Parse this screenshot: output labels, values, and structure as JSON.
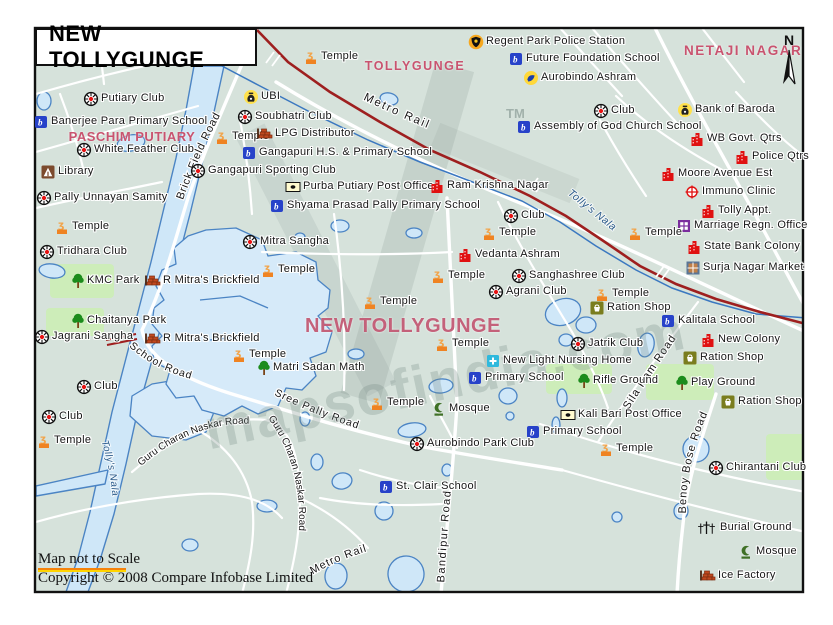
{
  "title": "NEW TOLLYGUNGE",
  "compass": {
    "north": "N"
  },
  "watermark": {
    "text": "mapsofindia.com",
    "tm": "TM"
  },
  "footer": {
    "scale_note": "Map not to Scale",
    "copyright": "Copyright © 2008 Compare Infobase Limited"
  },
  "palette": {
    "background": "#d6e2db",
    "water_fill": "#cfe7f8",
    "water_stroke": "#4b84c4",
    "road": "#ffffff",
    "railway": "#9e1f1f",
    "area_label_pink": "#c9536f",
    "green_patch": "#cdedb9"
  },
  "area_labels": [
    {
      "id": "paschim-putiary",
      "text": "PASCHIM PUTIARY",
      "x": 132,
      "y": 129,
      "size": 13,
      "spacing": 0.5
    },
    {
      "id": "tollygunge",
      "text": "TOLLYGUNGE",
      "x": 415,
      "y": 59,
      "size": 12.5,
      "spacing": 1.5
    },
    {
      "id": "netaji-nagar",
      "text": "NETAJI NAGAR",
      "x": 729,
      "y": 43,
      "size": 13.5,
      "spacing": 1.5,
      "two_line": true
    },
    {
      "id": "new-tollygunge-center",
      "text": "NEW TOLLYGUNGE",
      "x": 403,
      "y": 315,
      "size": 20,
      "spacing": 0.5
    }
  ],
  "road_labels": [
    {
      "id": "brickfield",
      "text": "Brick Field Road",
      "path": "p-brickfield",
      "size": 11,
      "spacing": 0.8,
      "offset": "22%"
    },
    {
      "id": "school-road",
      "text": "School Road",
      "path": "p-school",
      "size": 10.5,
      "spacing": 1,
      "offset": "4%"
    },
    {
      "id": "sree-pally",
      "text": "Sree Pally Road",
      "path": "p-sreepally",
      "size": 10.5,
      "spacing": 1,
      "offset": "2%"
    },
    {
      "id": "guru-1",
      "text": "Guru Charan Naskar Road",
      "path": "p-guru1",
      "size": 10,
      "spacing": 0,
      "offset": "1%"
    },
    {
      "id": "guru-2",
      "text": "Guru Charan Naskar Road",
      "path": "p-guru2",
      "size": 10,
      "spacing": 0,
      "offset": "1%"
    },
    {
      "id": "bandipur",
      "text": "Bandipur Road",
      "path": "p-bandipur",
      "size": 11,
      "spacing": 1.5,
      "offset": "3%"
    },
    {
      "id": "benoy-bose",
      "text": "Benoy Bose Road",
      "path": "p-benoy",
      "size": 11,
      "spacing": 1,
      "offset": "2%"
    },
    {
      "id": "sila-ram",
      "text": "Sila Ram Road",
      "path": "p-silaram",
      "size": 11,
      "spacing": 1,
      "offset": "4%"
    },
    {
      "id": "metro-rail-top",
      "text": "Metro Rail",
      "path": "p-metro1",
      "size": 11.5,
      "spacing": 2,
      "offset": "4%"
    },
    {
      "id": "metro-rail-bottom",
      "text": "Metro Rail",
      "path": "p-metro2",
      "size": 11,
      "spacing": 1,
      "offset": "4%"
    },
    {
      "id": "tollys-nala-right",
      "text": "Tolly's Nala",
      "path": "p-nala-r",
      "size": 10.5,
      "spacing": 0.5,
      "offset": "2%",
      "nala": true
    },
    {
      "id": "tollys-nala-left",
      "text": "Tolly's Nala",
      "path": "p-nala-l",
      "size": 10,
      "spacing": 0.5,
      "offset": "2%",
      "nala": true
    }
  ],
  "pois": [
    {
      "type": "club",
      "x": 91,
      "y": 99,
      "label": "Putiary Club"
    },
    {
      "type": "bank",
      "x": 251,
      "y": 97,
      "label": "UBI"
    },
    {
      "type": "temple",
      "x": 311,
      "y": 57,
      "label": "Temple"
    },
    {
      "type": "police",
      "x": 476,
      "y": 42,
      "label": "Regent Park Police Station"
    },
    {
      "type": "school",
      "x": 516,
      "y": 59,
      "label": "Future Foundation School"
    },
    {
      "type": "ashram",
      "x": 531,
      "y": 78,
      "label": "Aurobindo Ashram"
    },
    {
      "type": "school",
      "x": 41,
      "y": 122,
      "label": "Banerjee Para Primary School"
    },
    {
      "type": "club",
      "x": 245,
      "y": 117,
      "label": "Soubhatri Club"
    },
    {
      "type": "club",
      "x": 601,
      "y": 111,
      "label": "Club"
    },
    {
      "type": "bank",
      "x": 685,
      "y": 110,
      "label": "Bank of Baroda"
    },
    {
      "type": "temple",
      "x": 222,
      "y": 137,
      "label": "Temple"
    },
    {
      "type": "brick",
      "x": 264,
      "y": 134,
      "label": "LPG Distributor"
    },
    {
      "type": "school",
      "x": 524,
      "y": 127,
      "label": "Assembly of God Church School"
    },
    {
      "type": "club",
      "x": 84,
      "y": 150,
      "label": "White Feather Club"
    },
    {
      "type": "school",
      "x": 249,
      "y": 153,
      "label": "Gangapuri H.S. & Primary School"
    },
    {
      "type": "building",
      "x": 697,
      "y": 139,
      "label": "WB Govt. Qtrs"
    },
    {
      "type": "library",
      "x": 48,
      "y": 172,
      "label": "Library"
    },
    {
      "type": "club",
      "x": 198,
      "y": 171,
      "label": "Gangapuri Sporting Club"
    },
    {
      "type": "building",
      "x": 742,
      "y": 157,
      "label": "Police Qtrs"
    },
    {
      "type": "postoffice",
      "x": 293,
      "y": 187,
      "label": "Purba Putiary Post Office"
    },
    {
      "type": "building",
      "x": 437,
      "y": 186,
      "label": "Ram Krishna Nagar"
    },
    {
      "type": "building",
      "x": 668,
      "y": 174,
      "label": "Moore Avenue Est"
    },
    {
      "type": "club",
      "x": 44,
      "y": 198,
      "label": "Pally Unnayan Samity"
    },
    {
      "type": "school",
      "x": 277,
      "y": 206,
      "label": "Shyama Prasad Pally Primary School"
    },
    {
      "type": "clinic",
      "x": 692,
      "y": 192,
      "label": "Immuno Clinic"
    },
    {
      "type": "club",
      "x": 511,
      "y": 216,
      "label": "Club"
    },
    {
      "type": "building",
      "x": 708,
      "y": 211,
      "label": "Tolly Appt."
    },
    {
      "type": "temple",
      "x": 62,
      "y": 227,
      "label": "Temple"
    },
    {
      "type": "marriage",
      "x": 684,
      "y": 226,
      "label": "Marriage Regn. Office"
    },
    {
      "type": "club",
      "x": 250,
      "y": 242,
      "label": "Mitra Sangha"
    },
    {
      "type": "temple",
      "x": 635,
      "y": 233,
      "label": "Temple"
    },
    {
      "type": "temple",
      "x": 489,
      "y": 233,
      "label": "Temple"
    },
    {
      "type": "building",
      "x": 694,
      "y": 247,
      "label": "State Bank Colony"
    },
    {
      "type": "club",
      "x": 47,
      "y": 252,
      "label": "Tridhara Club"
    },
    {
      "type": "building",
      "x": 465,
      "y": 255,
      "label": "Vedanta Ashram"
    },
    {
      "type": "market",
      "x": 693,
      "y": 268,
      "label": "Surja Nagar Market"
    },
    {
      "type": "temple",
      "x": 268,
      "y": 270,
      "label": "Temple"
    },
    {
      "type": "club",
      "x": 519,
      "y": 276,
      "label": "Sanghashree Club"
    },
    {
      "type": "temple",
      "x": 438,
      "y": 276,
      "label": "Temple"
    },
    {
      "type": "tree",
      "x": 78,
      "y": 281,
      "label": "KMC Park"
    },
    {
      "type": "brick",
      "x": 152,
      "y": 281,
      "label": "R Mitra's Brickfield"
    },
    {
      "type": "club",
      "x": 496,
      "y": 292,
      "label": "Agrani Club"
    },
    {
      "type": "temple",
      "x": 602,
      "y": 294,
      "label": "Temple"
    },
    {
      "type": "ration",
      "x": 597,
      "y": 308,
      "label": "Ration Shop"
    },
    {
      "type": "temple",
      "x": 370,
      "y": 302,
      "label": "Temple"
    },
    {
      "type": "tree",
      "x": 78,
      "y": 321,
      "label": "Chaitanya Park"
    },
    {
      "type": "school",
      "x": 668,
      "y": 321,
      "label": "Kalitala School"
    },
    {
      "type": "club",
      "x": 42,
      "y": 337,
      "label": "Jagrani Sangha"
    },
    {
      "type": "brick",
      "x": 152,
      "y": 339,
      "label": "R Mitra's Brickfield"
    },
    {
      "type": "building",
      "x": 708,
      "y": 340,
      "label": "New Colony"
    },
    {
      "type": "temple",
      "x": 442,
      "y": 344,
      "label": "Temple"
    },
    {
      "type": "club",
      "x": 578,
      "y": 344,
      "label": "Jatrik Club"
    },
    {
      "type": "ration",
      "x": 690,
      "y": 358,
      "label": "Ration Shop"
    },
    {
      "type": "temple",
      "x": 239,
      "y": 355,
      "label": "Temple"
    },
    {
      "type": "tree",
      "x": 264,
      "y": 368,
      "label": "Matri Sadan Math"
    },
    {
      "type": "nursing",
      "x": 493,
      "y": 361,
      "label": "New Light Nursing Home"
    },
    {
      "type": "school",
      "x": 475,
      "y": 378,
      "label": "Primary School"
    },
    {
      "type": "tree",
      "x": 584,
      "y": 381,
      "label": "Rifle Ground"
    },
    {
      "type": "tree",
      "x": 682,
      "y": 383,
      "label": "Play Ground"
    },
    {
      "type": "club",
      "x": 84,
      "y": 387,
      "label": "Club"
    },
    {
      "type": "ration",
      "x": 728,
      "y": 402,
      "label": "Ration Shop"
    },
    {
      "type": "temple",
      "x": 377,
      "y": 403,
      "label": "Temple"
    },
    {
      "type": "mosque",
      "x": 439,
      "y": 409,
      "label": "Mosque"
    },
    {
      "type": "club",
      "x": 49,
      "y": 417,
      "label": "Club"
    },
    {
      "type": "postoffice",
      "x": 568,
      "y": 415,
      "label": "Kali Bari Post Office"
    },
    {
      "type": "school",
      "x": 533,
      "y": 432,
      "label": "Primary School"
    },
    {
      "type": "temple",
      "x": 44,
      "y": 441,
      "label": "Temple"
    },
    {
      "type": "club",
      "x": 417,
      "y": 444,
      "label": "Aurobindo Park Club"
    },
    {
      "type": "temple",
      "x": 606,
      "y": 449,
      "label": "Temple"
    },
    {
      "type": "club",
      "x": 716,
      "y": 468,
      "label": "Chirantani Club"
    },
    {
      "type": "school",
      "x": 386,
      "y": 487,
      "label": "St. Clair School"
    },
    {
      "type": "burial",
      "x": 706,
      "y": 528,
      "label": "Burial Ground"
    },
    {
      "type": "mosque",
      "x": 746,
      "y": 552,
      "label": "Mosque"
    },
    {
      "type": "brick",
      "x": 707,
      "y": 576,
      "label": "Ice Factory"
    }
  ]
}
